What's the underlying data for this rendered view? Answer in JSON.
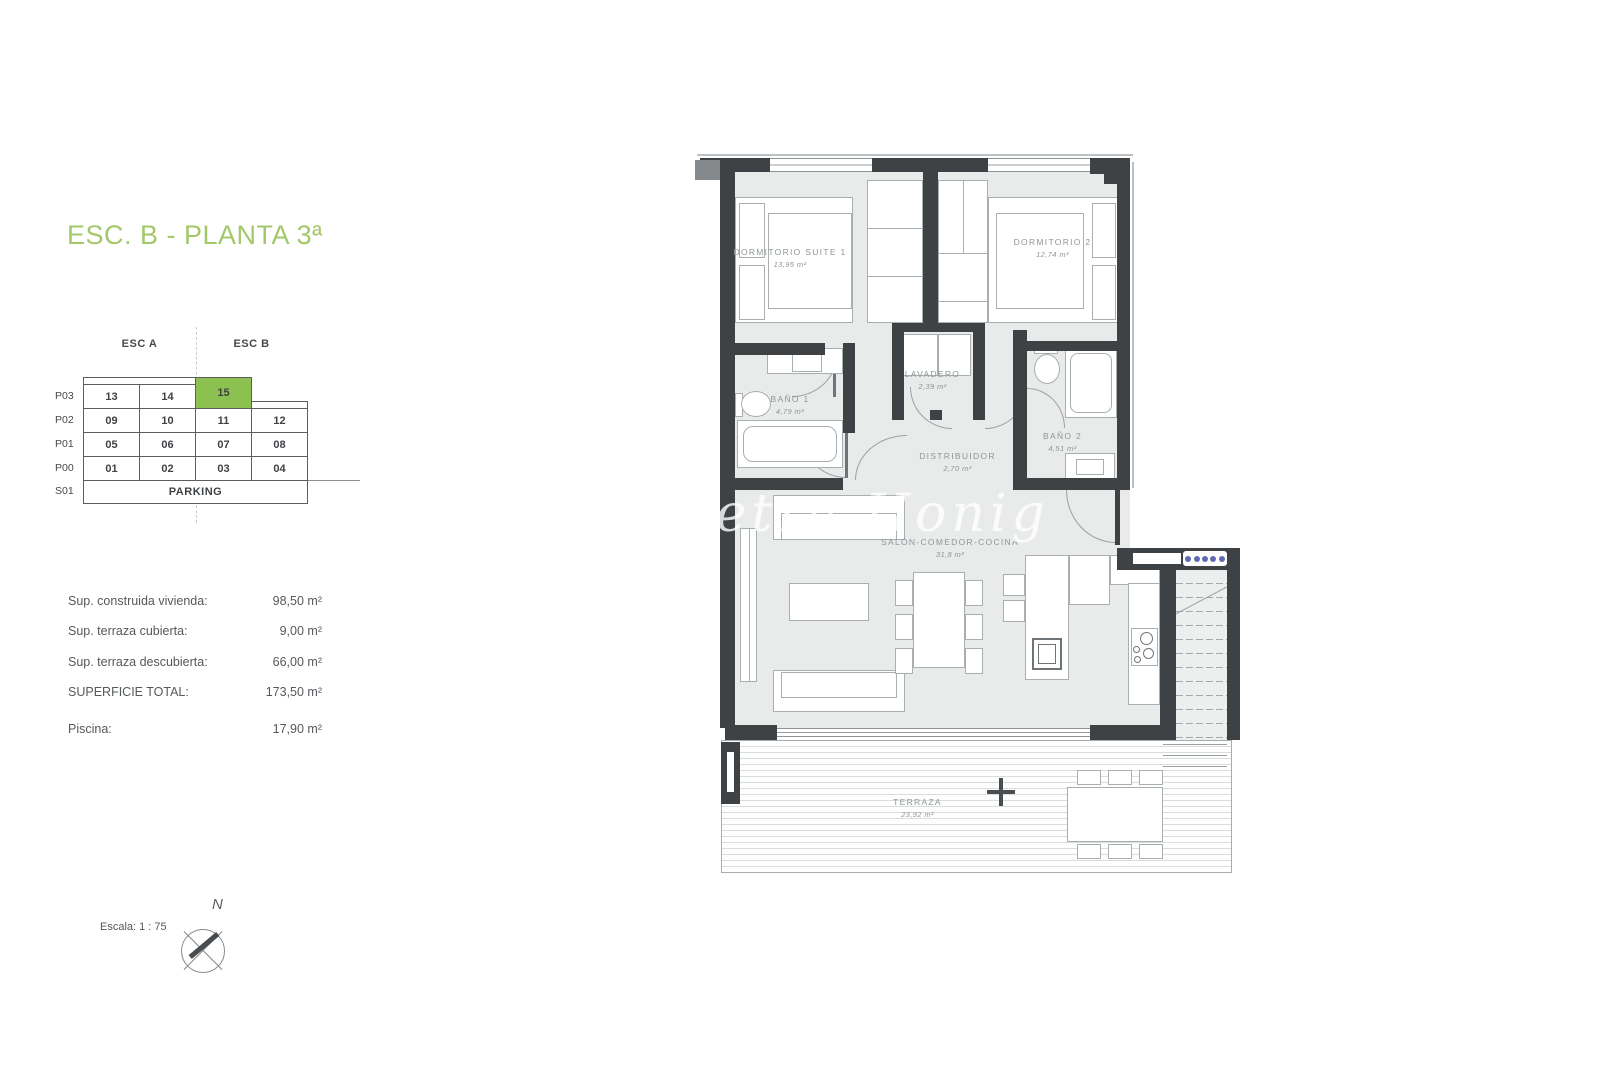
{
  "title": {
    "text": "ESC. B - PLANTA 3ª",
    "color": "#a3c869"
  },
  "matrix": {
    "esc_a": "ESC A",
    "esc_b": "ESC B",
    "rows": [
      {
        "level": "P03",
        "cells": [
          "13",
          "14",
          "15"
        ]
      },
      {
        "level": "P02",
        "cells": [
          "09",
          "10",
          "11",
          "12"
        ]
      },
      {
        "level": "P01",
        "cells": [
          "05",
          "06",
          "07",
          "08"
        ]
      },
      {
        "level": "P00",
        "cells": [
          "01",
          "02",
          "03",
          "04"
        ]
      }
    ],
    "parking_level": "S01",
    "parking_label": "PARKING",
    "highlight_cell": "15",
    "highlight_color": "#8cc152"
  },
  "surfaces": {
    "items": [
      {
        "label": "Sup. construida vivienda:",
        "value": "98,50 m²"
      },
      {
        "label": "Sup. terraza cubierta:",
        "value": "9,00 m²"
      },
      {
        "label": "Sup. terraza descubierta:",
        "value": "66,00 m²"
      },
      {
        "label": "SUPERFICIE TOTAL:",
        "value": "173,50 m²"
      },
      {
        "label": "Piscina:",
        "value": "17,90 m²"
      }
    ]
  },
  "scale_label": "Escala: 1 : 75",
  "compass": {
    "north": "N"
  },
  "watermark": {
    "text": "Petra Honig"
  },
  "floorplan": {
    "wall_color": "#3f4245",
    "floor_color": "#e9ebeb",
    "rooms": [
      {
        "name": "DORMITORIO SUITE 1",
        "area": "13,95 m²"
      },
      {
        "name": "DORMITORIO 2",
        "area": "12,74 m²"
      },
      {
        "name": "BAÑO 1",
        "area": "4,79 m²"
      },
      {
        "name": "LAVADERO",
        "area": "2,39 m²"
      },
      {
        "name": "DISTRIBUIDOR",
        "area": "2,70 m²"
      },
      {
        "name": "BAÑO 2",
        "area": "4,51 m²"
      },
      {
        "name": "SALÓN-COMEDOR-COCINA",
        "area": "31,8 m²"
      },
      {
        "name": "TERRAZA",
        "area": "23,92 m²"
      }
    ]
  }
}
